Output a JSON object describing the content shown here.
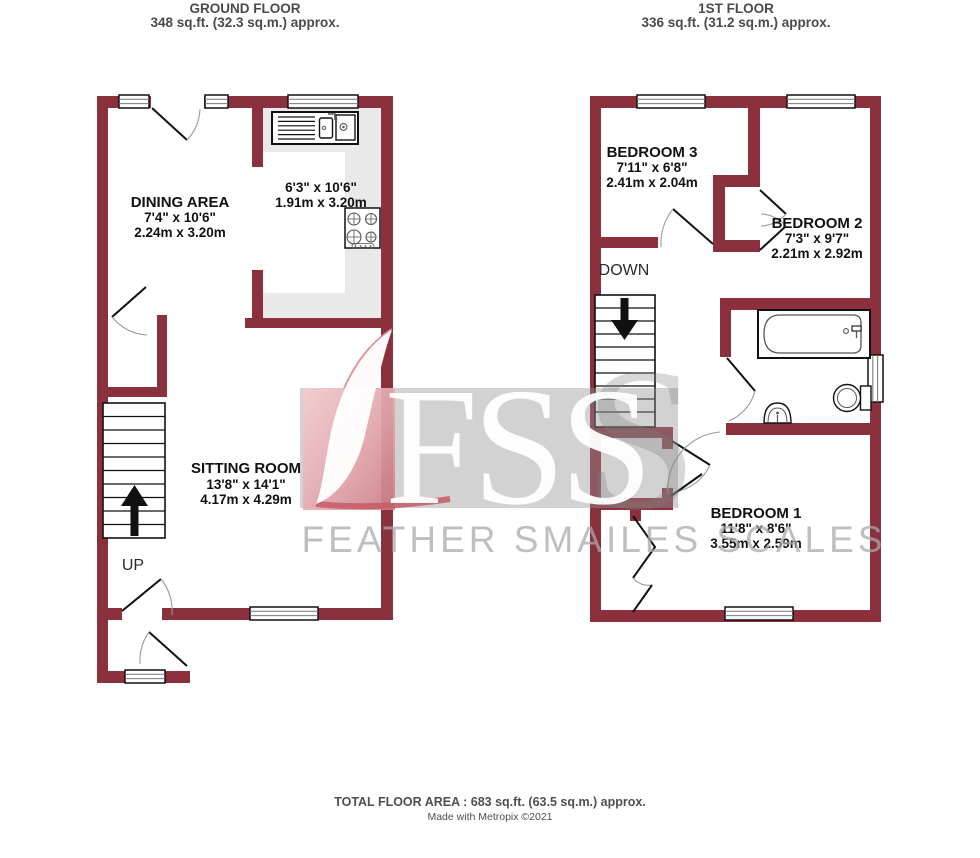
{
  "ground_floor": {
    "title": "GROUND FLOOR",
    "area": "348 sq.ft. (32.3 sq.m.) approx.",
    "dining": {
      "name": "DINING AREA",
      "imperial": "7'4\"  x 10'6\"",
      "metric": "2.24m  x 3.20m"
    },
    "kitchen": {
      "imperial": "6'3\"  x 10'6\"",
      "metric": "1.91m  x 3.20m"
    },
    "sitting": {
      "name": "SITTING ROOM",
      "imperial": "13'8\"  x 14'1\"",
      "metric": "4.17m  x 4.29m"
    },
    "stairs_label": "UP"
  },
  "first_floor": {
    "title": "1ST FLOOR",
    "area": "336 sq.ft. (31.2 sq.m.) approx.",
    "bedroom3": {
      "name": "BEDROOM 3",
      "imperial": "7'11\"  x 6'8\"",
      "metric": "2.41m  x 2.04m"
    },
    "bedroom2": {
      "name": "BEDROOM 2",
      "imperial": "7'3\"  x 9'7\"",
      "metric": "2.21m  x 2.92m"
    },
    "bedroom1": {
      "name": "BEDROOM 1",
      "imperial": "11'8\"  x 8'6\"",
      "metric": "3.55m  x 2.59m"
    },
    "stairs_label": "DOWN"
  },
  "watermark": {
    "initials": "FSS",
    "big_letter": "S",
    "company": "FEATHER SMAILES SCALES"
  },
  "footer": {
    "total_area": "TOTAL FLOOR AREA : 683 sq.ft. (63.5 sq.m.) approx.",
    "credit": "Made with Metropix ©2021"
  },
  "colors": {
    "wall": "#8b303d",
    "counter": "#e9e9e9",
    "watermark_band": "#949494",
    "feather_pink": "#eab6ba"
  }
}
